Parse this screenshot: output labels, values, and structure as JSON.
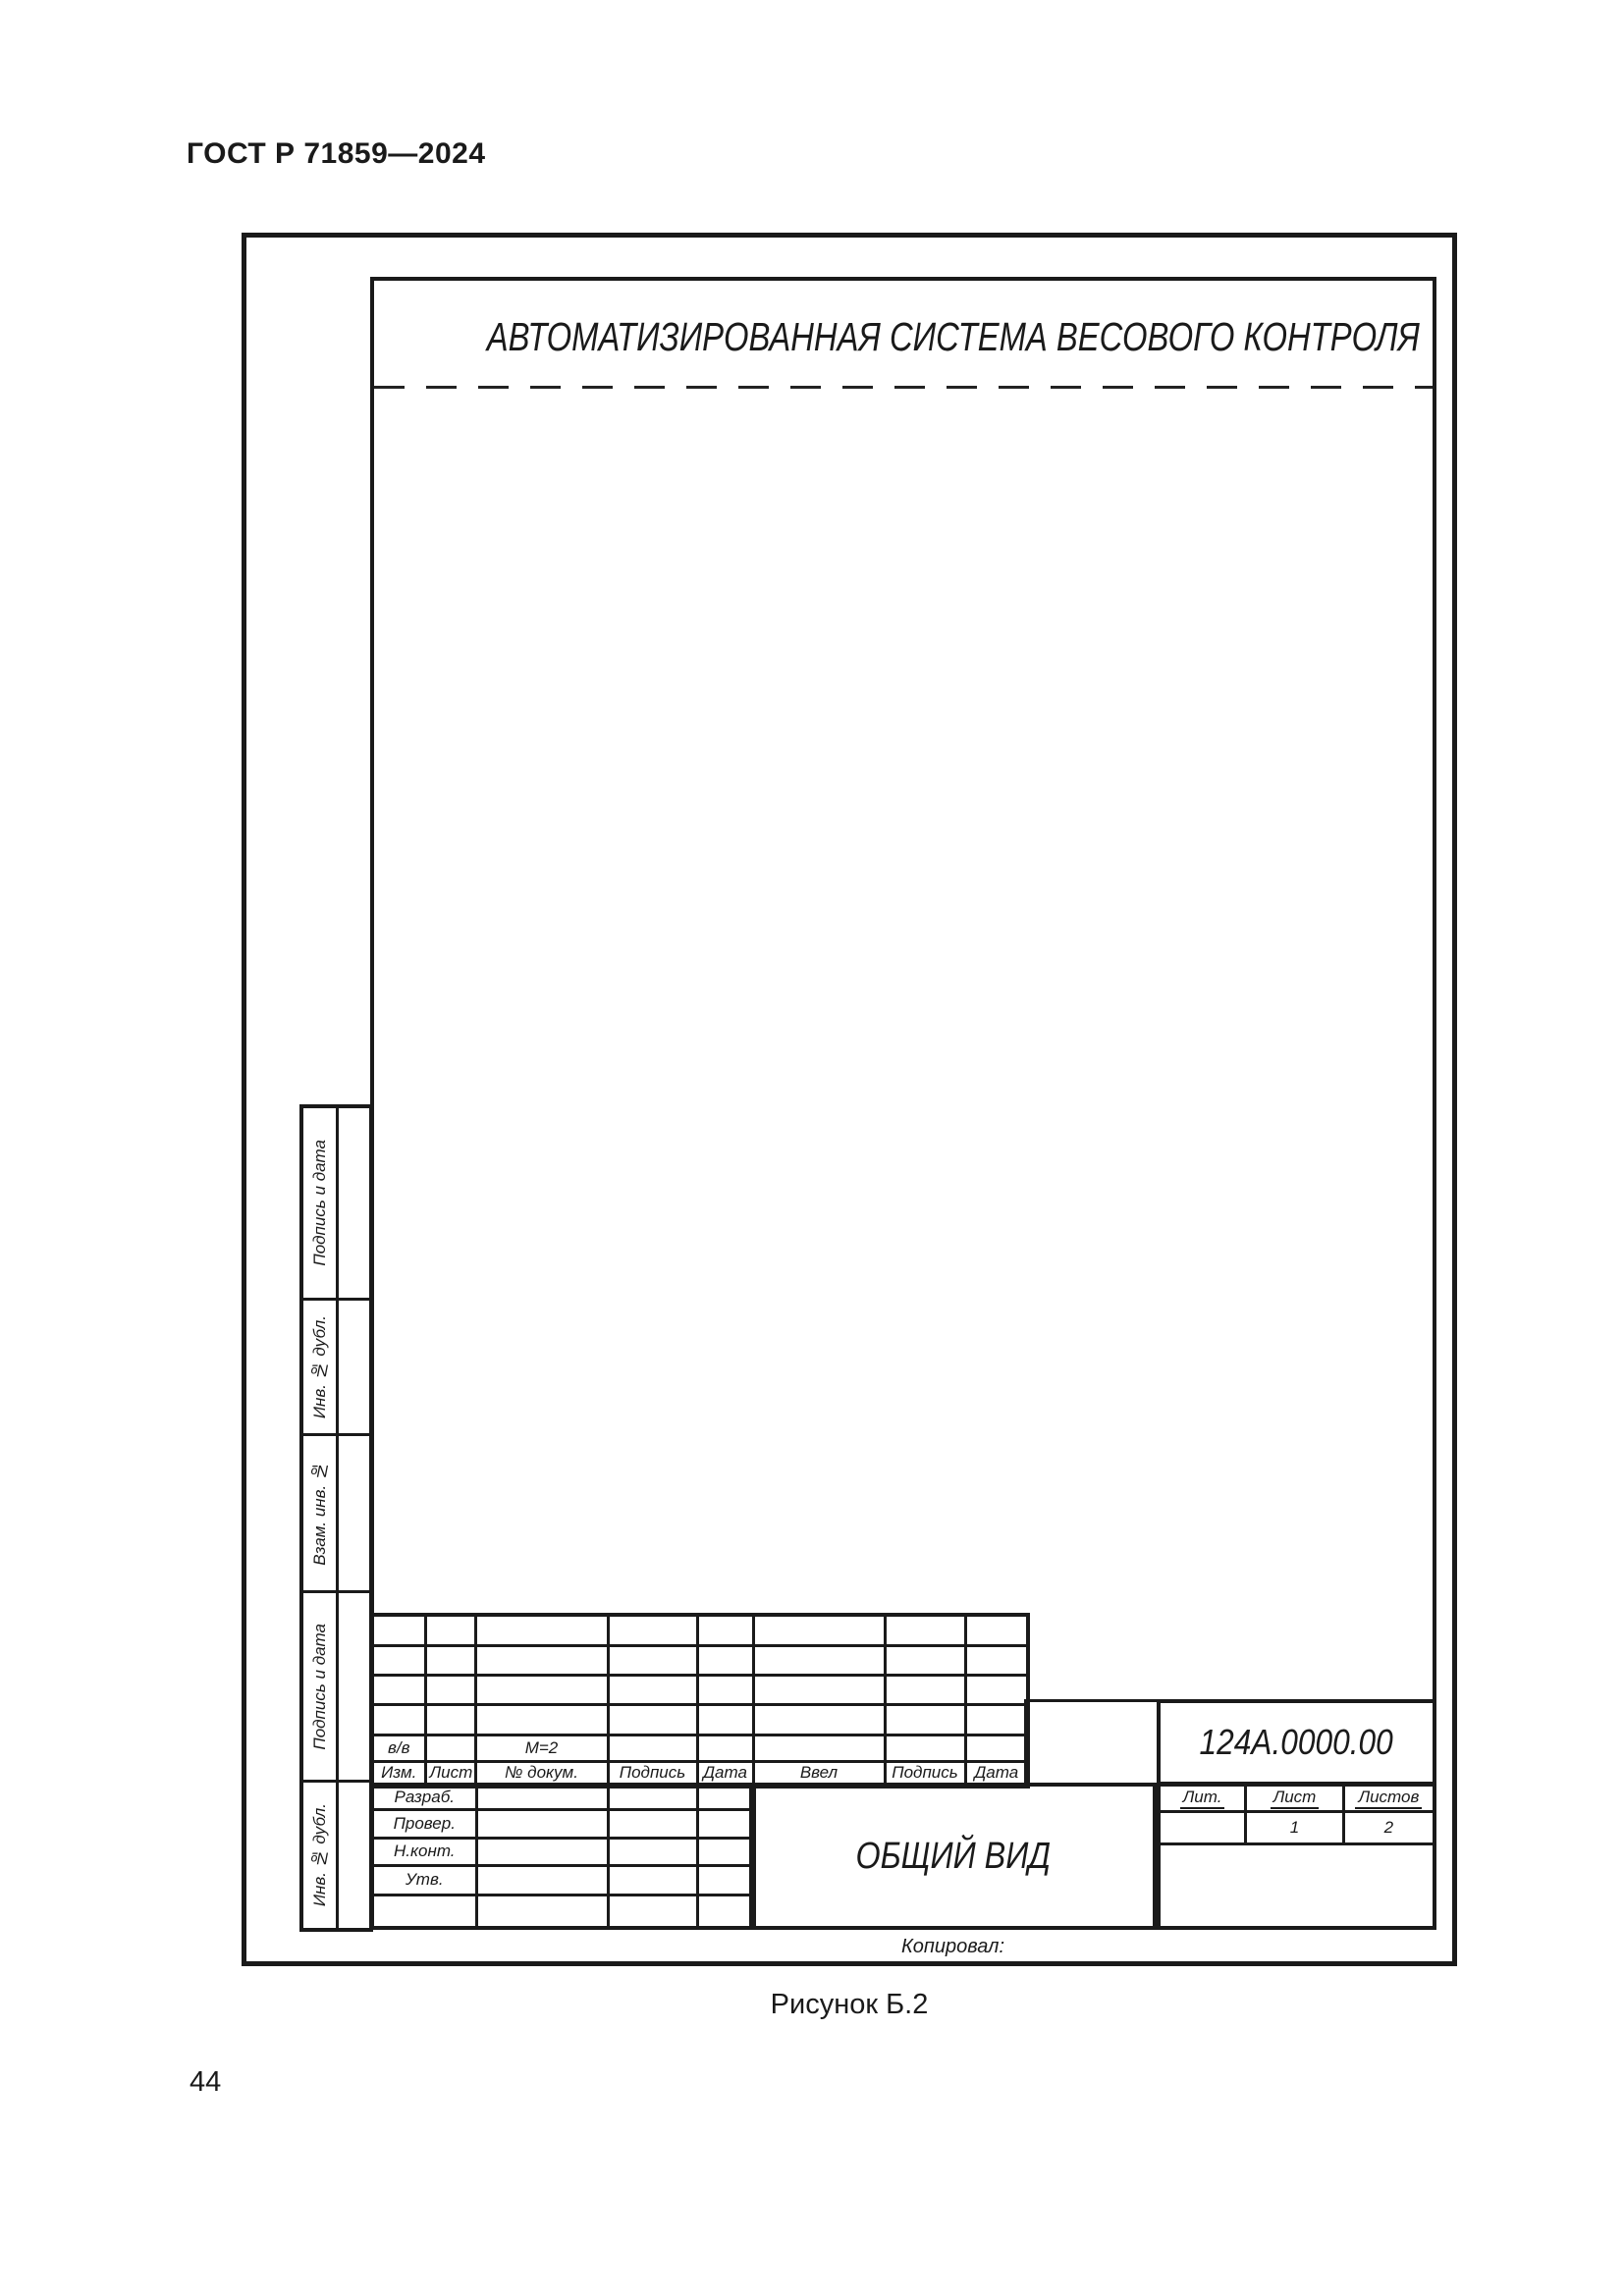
{
  "page": {
    "standard_ref": "ГОСТ Р 71859—2024",
    "figure_caption": "Рисунок Б.2",
    "page_number": "44"
  },
  "drawing": {
    "title": "АВТОМАТИЗИРОВАННАЯ СИСТЕМА ВЕСОВОГО КОНТРОЛЯ",
    "copied_label": "Копировал:",
    "side_column": {
      "labels": [
        "Подпись и дата",
        "Инв. № дубл.",
        "Взам. инв. №",
        "Подпись и дата",
        "Инв. № дубл."
      ]
    },
    "title_block": {
      "change_table": {
        "record_row": {
          "izm": "в/в",
          "doc": "М=2"
        },
        "headers": [
          "Изм.",
          "Лист",
          "№ докум.",
          "Подпись",
          "Дата",
          "Ввел",
          "Подпись",
          "Дата"
        ]
      },
      "signature_rows": [
        "Разраб.",
        "Провер.",
        "Н.конт.",
        "Утв.",
        ""
      ],
      "document_name": "ОБЩИЙ ВИД",
      "designation": "124А.0000.00",
      "lit_section": {
        "headers": [
          "Лит.",
          "Лист",
          "Листов"
        ],
        "values": [
          "",
          "1",
          "2"
        ]
      }
    },
    "colors": {
      "ink": "#1a1a1a",
      "paper": "#ffffff"
    }
  }
}
